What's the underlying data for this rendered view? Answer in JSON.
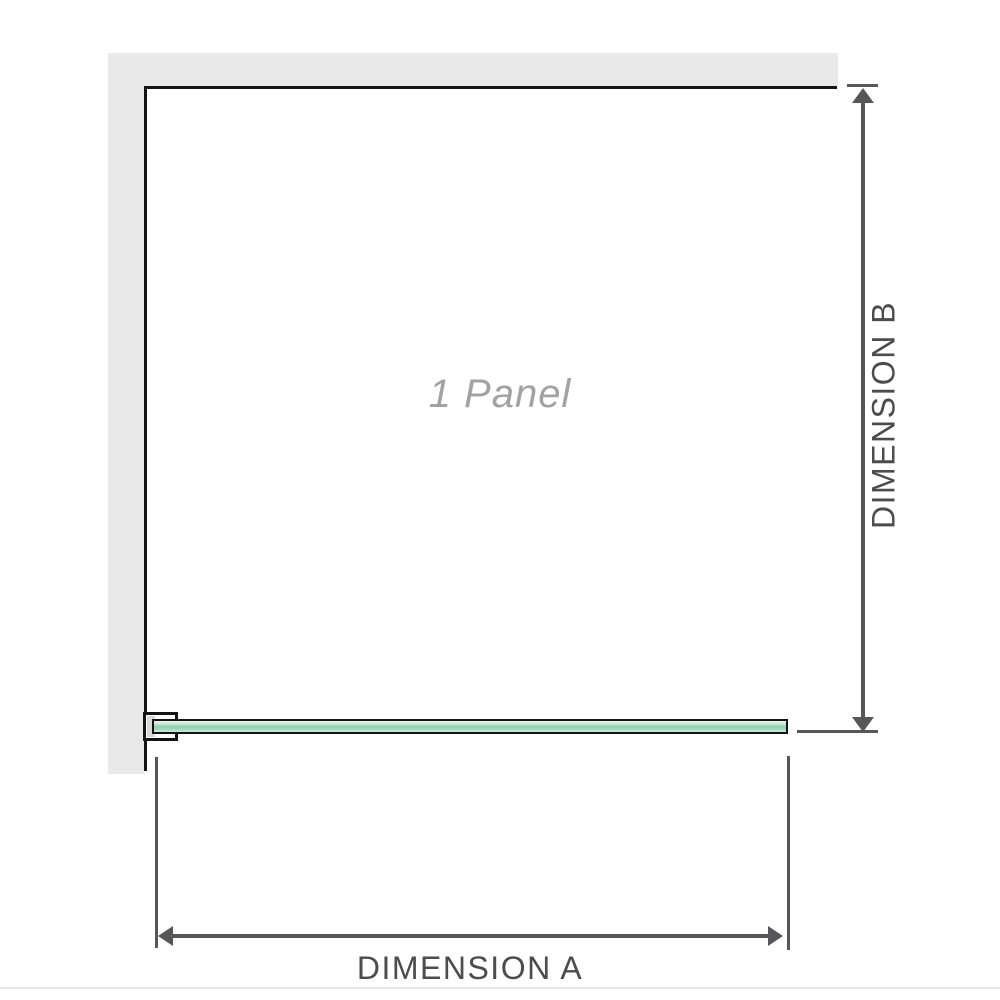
{
  "diagram": {
    "panel_label": "1 Panel",
    "dimension_a_label": "DIMENSION A",
    "dimension_b_label": "DIMENSION B",
    "colors": {
      "wall_fill": "#e9e9e9",
      "outline": "#141414",
      "glass_green_light": "#d9efe3",
      "glass_green_mid": "#8fd0ae",
      "dimension_line": "#57575a",
      "dimension_text": "#4c4c4e",
      "panel_label_text": "#a2a2a4",
      "bracket_fill": "#d9d9d9",
      "footer_rule": "#e9e6e6"
    }
  }
}
